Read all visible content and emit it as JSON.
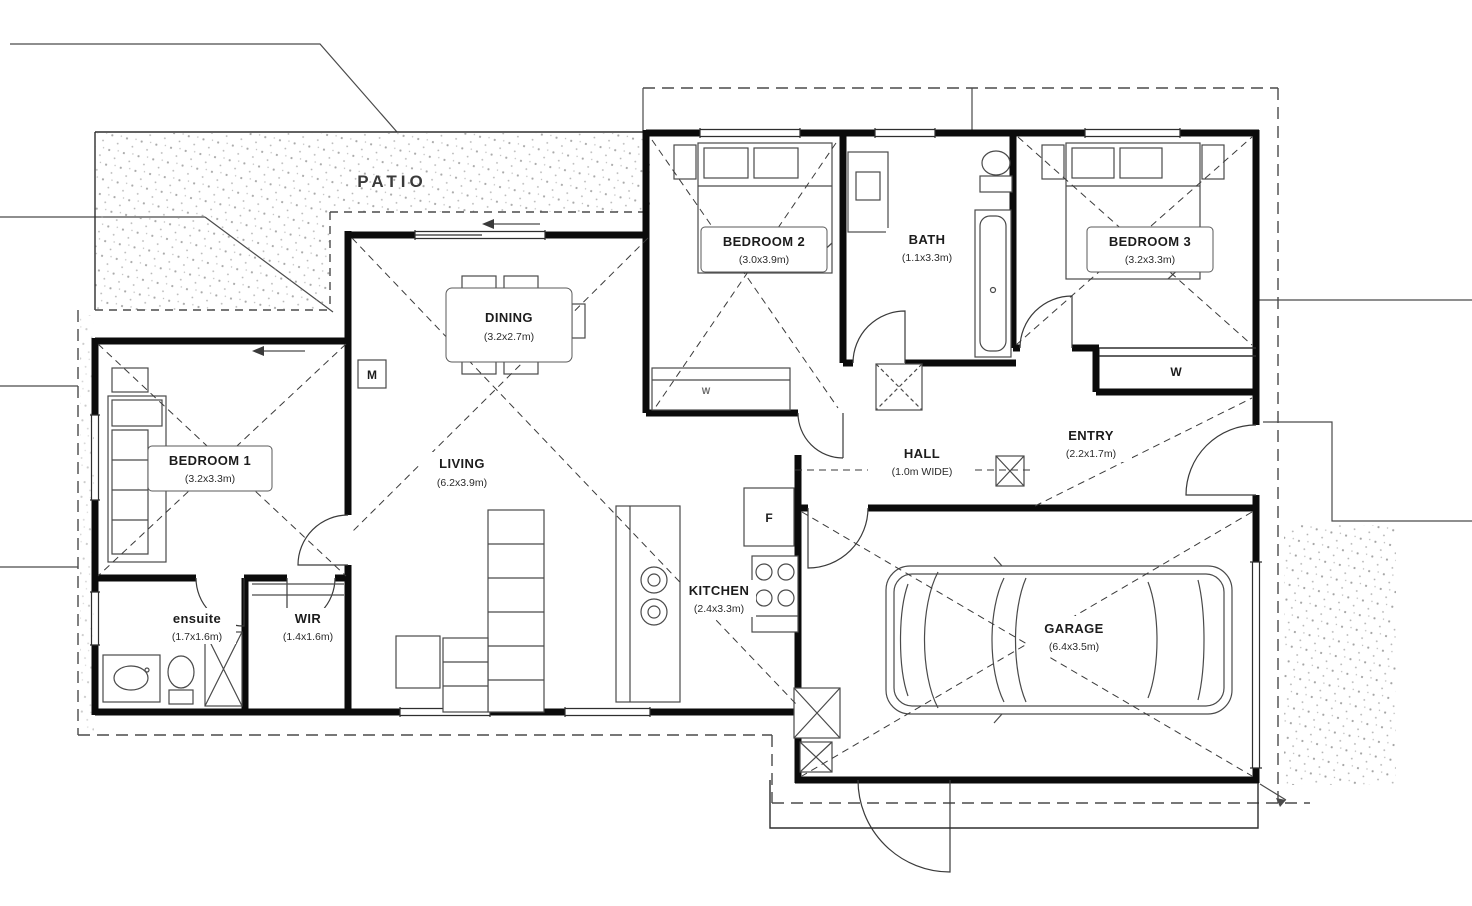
{
  "plan": {
    "patio": {
      "label": "PATIO"
    },
    "rooms": {
      "bedroom2": {
        "name": "BEDROOM 2",
        "dims": "(3.0x3.9m)"
      },
      "bath": {
        "name": "BATH",
        "dims": "(1.1x3.3m)"
      },
      "bedroom3": {
        "name": "BEDROOM 3",
        "dims": "(3.2x3.3m)"
      },
      "dining": {
        "name": "DINING",
        "dims": "(3.2x2.7m)"
      },
      "living": {
        "name": "LIVING",
        "dims": "(6.2x3.9m)"
      },
      "bedroom1": {
        "name": "BEDROOM 1",
        "dims": "(3.2x3.3m)"
      },
      "hall": {
        "name": "HALL",
        "dims": "(1.0m WIDE)"
      },
      "entry": {
        "name": "ENTRY",
        "dims": "(2.2x1.7m)"
      },
      "kitchen": {
        "name": "KITCHEN",
        "dims": "(2.4x3.3m)"
      },
      "garage": {
        "name": "GARAGE",
        "dims": "(6.4x3.5m)"
      },
      "ensuite": {
        "name": "ensuite",
        "dims": "(1.7x1.6m)"
      },
      "wir": {
        "name": "WIR",
        "dims": "(1.4x1.6m)"
      }
    },
    "markers": {
      "wardrobe_label": "W",
      "robe_label": "W",
      "fridge_label": "F",
      "meter_label": "M"
    },
    "colors": {
      "wall": "#0b0b0b",
      "line": "#2e2e2e",
      "bg": "#ffffff"
    }
  }
}
